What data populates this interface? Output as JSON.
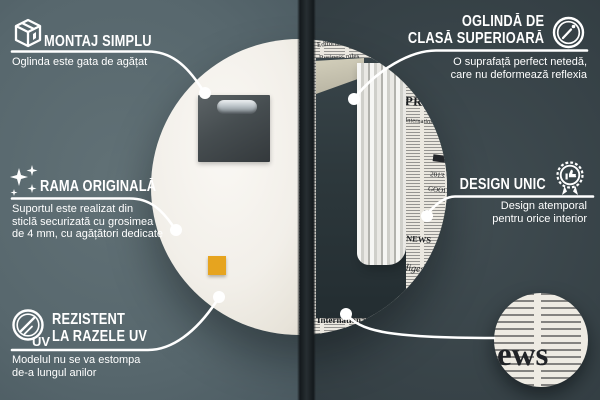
{
  "colors": {
    "background_left": "#57666b",
    "background_right": "#343e42",
    "connector": "#ffffff",
    "mirror_back": "#f4f2ed",
    "newsprint_paper": "#ebe8e0",
    "sticker": "#e6a41f",
    "reflection_wall": "#2d383c",
    "curtain": "#eeedea",
    "ceiling": "#c9c5b3"
  },
  "callouts": {
    "montaj": {
      "title": "MONTAJ SIMPLU",
      "subtitle": "Oglinda este gata de agățat"
    },
    "clasa": {
      "title_line1": "OGLINDĂ DE",
      "title_line2": "CLASĂ SUPERIOARĂ",
      "subtitle_line1": "O suprafață perfect netedă,",
      "subtitle_line2": "care nu deformează reflexia"
    },
    "rama": {
      "title": "RAMA ORIGINALĂ",
      "subtitle_line1": "Suportul este realizat din",
      "subtitle_line2": "sticlă securizată cu grosimea",
      "subtitle_line3": "de 4 mm, cu agățători dedicate"
    },
    "design": {
      "title": "DESIGN UNIC",
      "subtitle_line1": "Design atemporal",
      "subtitle_line2": "pentru orice interior"
    },
    "uv": {
      "title_line1": "REZISTENT",
      "title_line2": "LA RAZELE UV",
      "icon_label": "UV",
      "subtitle_line1": "Modelul nu se va estompa",
      "subtitle_line2": "de-a lungul anilor"
    }
  },
  "newspaper": {
    "words": [
      "Editorial analysis",
      "Business",
      "Business rules",
      "PRESS",
      "International",
      "2013",
      "GOOD",
      "NEWS",
      "& digest",
      "International news"
    ],
    "detail_text": "ews"
  }
}
